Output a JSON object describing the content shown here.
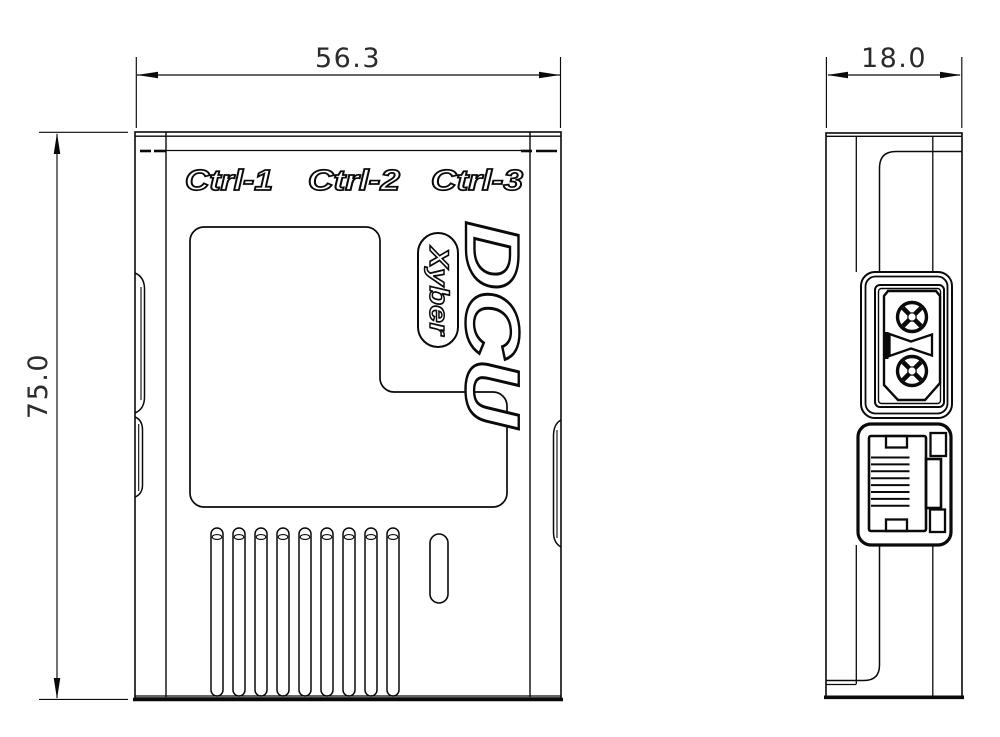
{
  "drawing": {
    "title": "DCU enclosure engineering drawing, front and side views",
    "product_name": "DCU",
    "brand": "Xyber",
    "port_labels": {
      "ctrl1": "Ctrl-1",
      "ctrl2": "Ctrl-2",
      "ctrl3": "Ctrl-3"
    },
    "dimensions": {
      "width_mm": "56.3",
      "height_mm": "75.0",
      "depth_mm": "18.0"
    },
    "features": {
      "vent_slot_count": 9,
      "connectors": [
        "xt30-power-connector",
        "rj45-ethernet-jack"
      ]
    },
    "colors": {
      "line": "#0a0a0a",
      "dimension_text": "#2b2b2b",
      "background": "#ffffff"
    }
  }
}
